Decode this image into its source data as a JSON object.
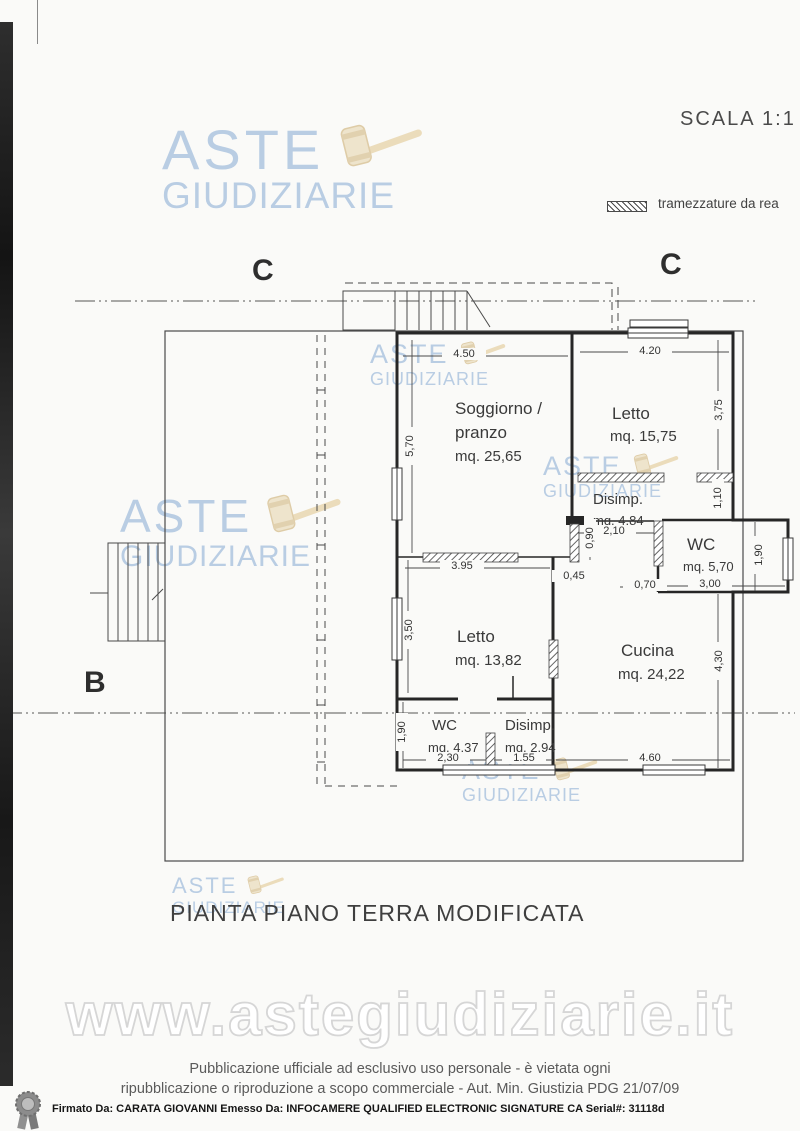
{
  "page": {
    "scale_label": "SCALA 1:1",
    "legend_label": "tramezzature da rea",
    "title": "PIANTA PIANO TERRA MODIFICATA"
  },
  "watermark": {
    "brand_line1": "ASTE",
    "brand_line2": "GIUDIZIARIE",
    "url": "www.astegiudiziarie.it"
  },
  "footer": {
    "line1": "Pubblicazione ufficiale ad esclusivo uso personale - è vietata ogni",
    "line2": "ripubblicazione o riproduzione a scopo commerciale - Aut. Min. Giustizia PDG 21/07/09",
    "signature": "Firmato Da: CARATA GIOVANNI Emesso Da: INFOCAMERE QUALIFIED ELECTRONIC SIGNATURE CA Serial#: 31118d"
  },
  "plan": {
    "markers": {
      "c_left": "C",
      "c_right": "C",
      "b": "B"
    },
    "rooms": {
      "soggiorno": {
        "name": "Soggiorno /",
        "name2": "pranzo",
        "area": "mq. 25,65"
      },
      "letto1": {
        "name": "Letto",
        "area": "mq. 15,75"
      },
      "disimp1": {
        "name": "Disimp.",
        "area": "mq. 4,84"
      },
      "wc1": {
        "name": "WC",
        "area": "mq. 5,70"
      },
      "letto2": {
        "name": "Letto",
        "area": "mq. 13,82"
      },
      "cucina": {
        "name": "Cucina",
        "area": "mq. 24,22"
      },
      "wc2": {
        "name": "WC",
        "area": "mq. 4,37"
      },
      "disimp2": {
        "name": "Disimp.",
        "area": "mq. 2,94"
      }
    },
    "dims": {
      "soggiorno_top": "4.50",
      "soggiorno_left": "5,70",
      "letto1_top": "4.20",
      "letto1_right": "3,75",
      "disimp1_right": "1,10",
      "corridor_len": "2,10",
      "corridor_w": "0,90",
      "niche": "0,45",
      "wc1_offset": "0,70",
      "wc1_width": "3,00",
      "wc1_bay": "1,90",
      "letto2_top": "3.95",
      "letto2_left": "3,50",
      "cucina_right": "4,30",
      "wc2_left": "1,90",
      "wc2_bottom": "2,30",
      "disimp2_bottom": "1.55",
      "cucina_bottom": "4.60"
    }
  },
  "colors": {
    "brand_blue": "#a9c2df",
    "gavel_beige": "#ecdfc2",
    "wall": "#262626",
    "thin_line": "#4a4a4a",
    "url_outline": "#d6d6d6"
  }
}
